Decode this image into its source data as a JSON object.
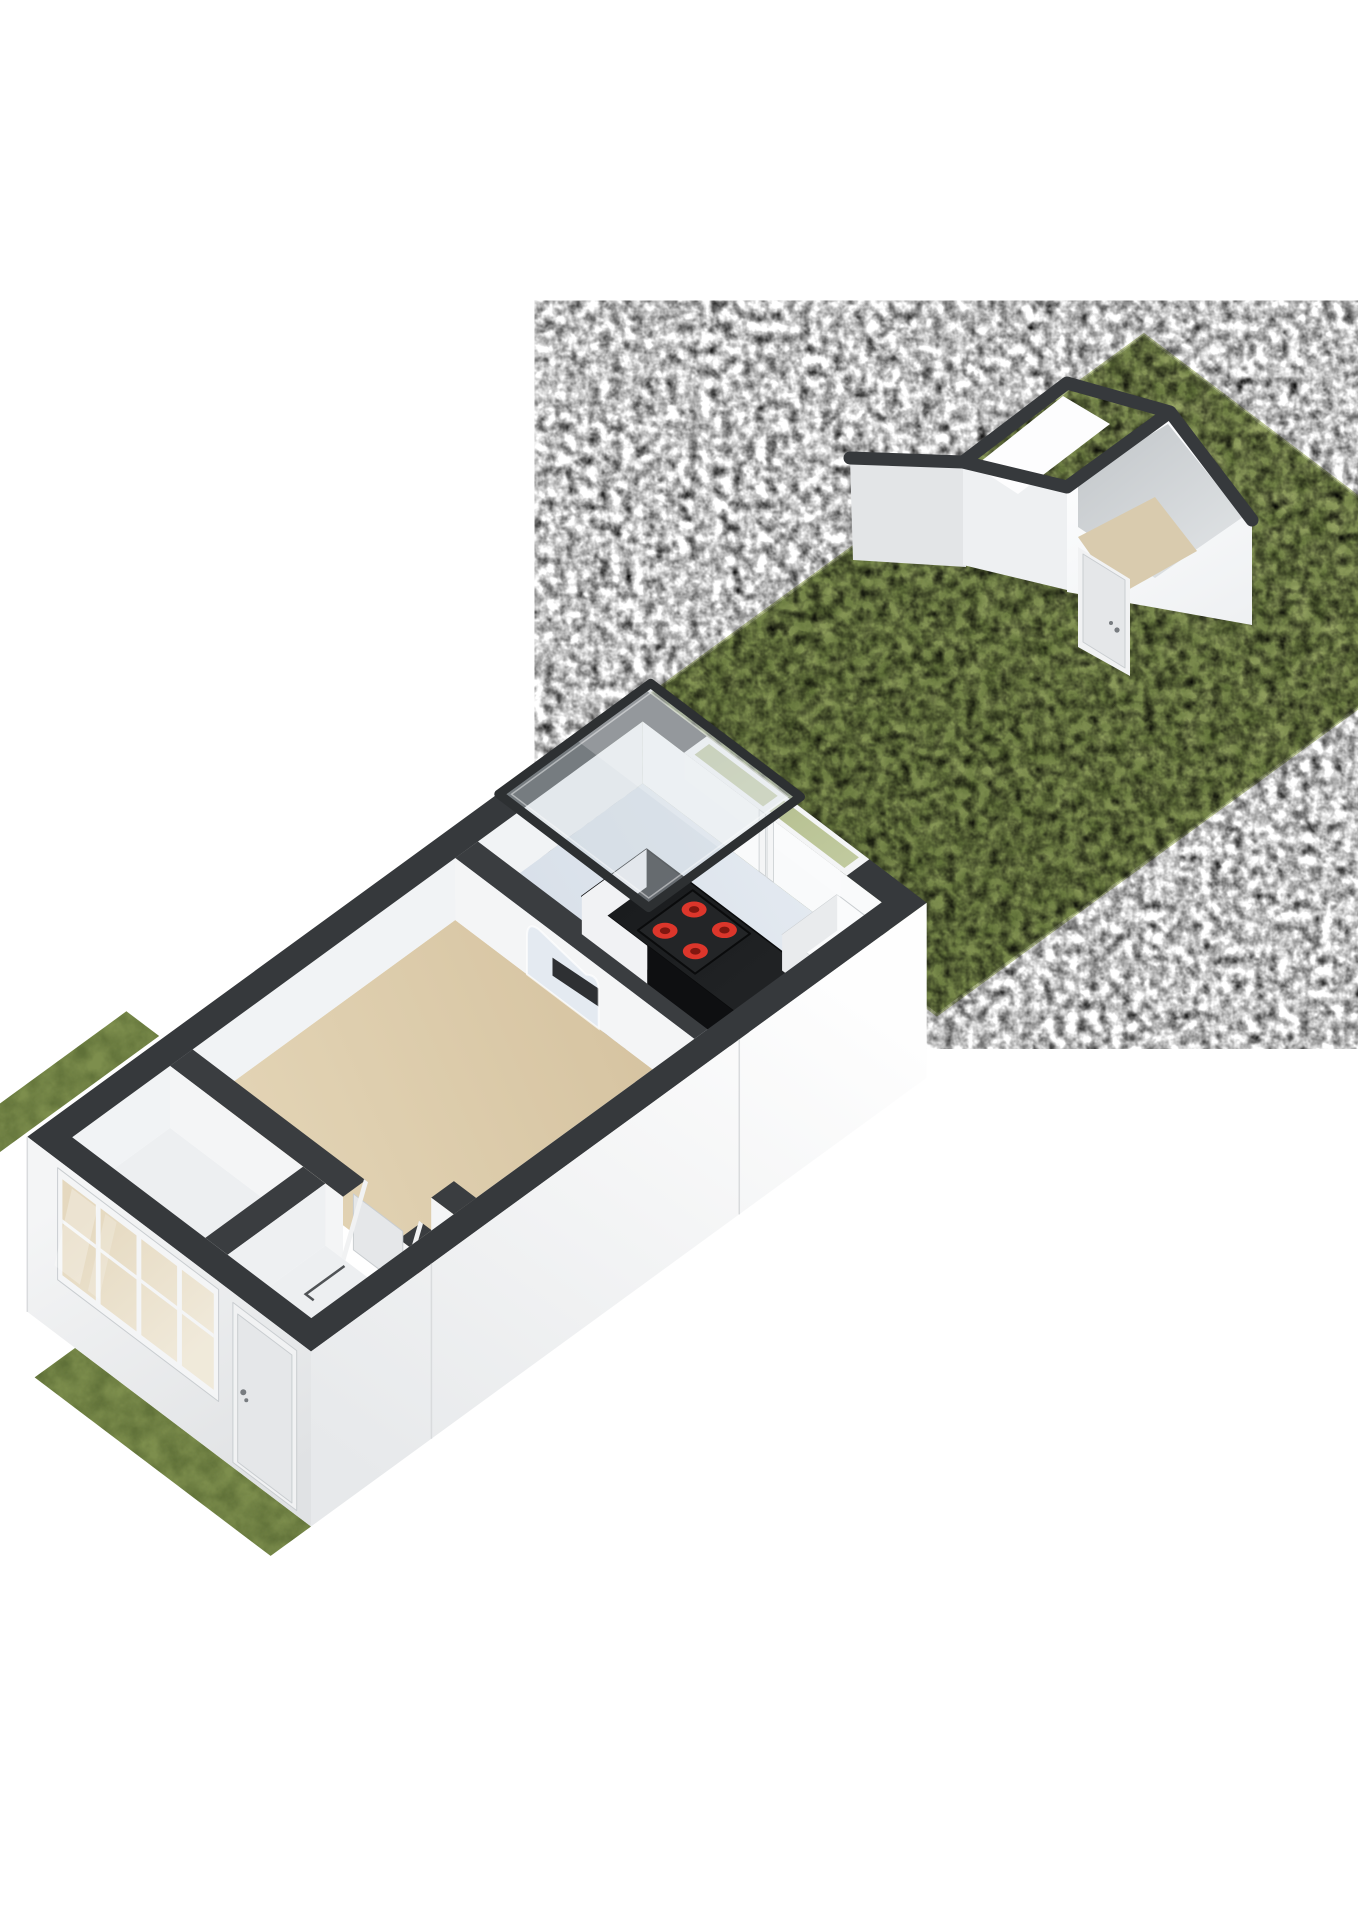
{
  "scene": {
    "type": "3d-floorplan-axonometric",
    "label": "3d-floorplan-ground-floor-with-garden-and-shed",
    "background": "#ffffff",
    "rooms": [
      {
        "name": "kitchen",
        "floor_color": "#dde4ec"
      },
      {
        "name": "living-room",
        "floor_color": "#dac8a7"
      },
      {
        "name": "hallway",
        "floor_color": "#edeff1"
      },
      {
        "name": "wc",
        "floor_color": "#edeff1"
      },
      {
        "name": "shed",
        "floor_color": "#d9cbae"
      }
    ],
    "cooktop_burners": 4,
    "objects": [
      "garden",
      "shed",
      "shed-door",
      "skylight",
      "kitchen-counter",
      "cooktop",
      "kitchen-cabinet",
      "kitchen-window",
      "living-window",
      "front-door",
      "radiator",
      "door-swing-mark",
      "grass-strips"
    ]
  },
  "colors": {
    "background": "#ffffff",
    "wallTop": "#36393c",
    "wallTopInner": "#3a3d40",
    "extFaceSE1": "#fefefe",
    "extFaceSE2": "#e7e9eb",
    "extFaceSW1": "#f4f5f6",
    "extFaceSW2": "#e0e2e4",
    "innerNW": "#f1f3f5",
    "innerNE": "#f9fafb",
    "innerSE": "#f0f2f3",
    "innerSW": "#f3f4f6",
    "kitchenFloor1": "#e4eaf1",
    "kitchenFloor2": "#d6dee8",
    "livingFloor1": "#e6d8ba",
    "livingFloor2": "#d4c19e",
    "hallFloor": "#edeff1",
    "grass1": "#9aa767",
    "grass2": "#7d8e4d",
    "grassDark": "#5f7038",
    "grassLight": "#b4bf85",
    "grassEdge": "#c2cc9a",
    "counterTop": "#1a1c1e",
    "counterDark": "#0e0f11",
    "counterWhite": "#f1f2f4",
    "cooktopPanel": "#232527",
    "cooktopEdge": "#0a0b0c",
    "burnerRed": "#dc362b",
    "burnerCore": "#801710",
    "cabinetTop": "#fafbfc",
    "cabinetFace": "#e9ebed",
    "frameWhite": "#f4f5f6",
    "frameEdge": "#c9cdd0",
    "glassGrass1": "#a3ae77",
    "glassGrass2": "#c6cfa4",
    "glassInterior1": "#e4d7bc",
    "glassInterior2": "#f0e9d9",
    "doorLeaf": "#e5e7e9",
    "doorFrame": "#f1f2f3",
    "handle": "#787c80",
    "skyFrame": "#2d3032",
    "skyGlass": "#cfd9df",
    "sheen": "#ffffff",
    "shedFaceLight": "#fbfcfd",
    "shedFaceMid": "#eef0f2",
    "shedFaceGray": "#e3e5e7",
    "shedInner1": "#c7cbce",
    "shedInner2": "#e2e5e7",
    "shedInnerWhite": "#fdfdfe",
    "shedFloor": "#d9cbae",
    "radiatorRed": "#b3342c",
    "radiatorWhite": "#f6f7f8",
    "swingMark": "#505356",
    "seam": "#d9dbdd",
    "shadow": "#000000"
  }
}
